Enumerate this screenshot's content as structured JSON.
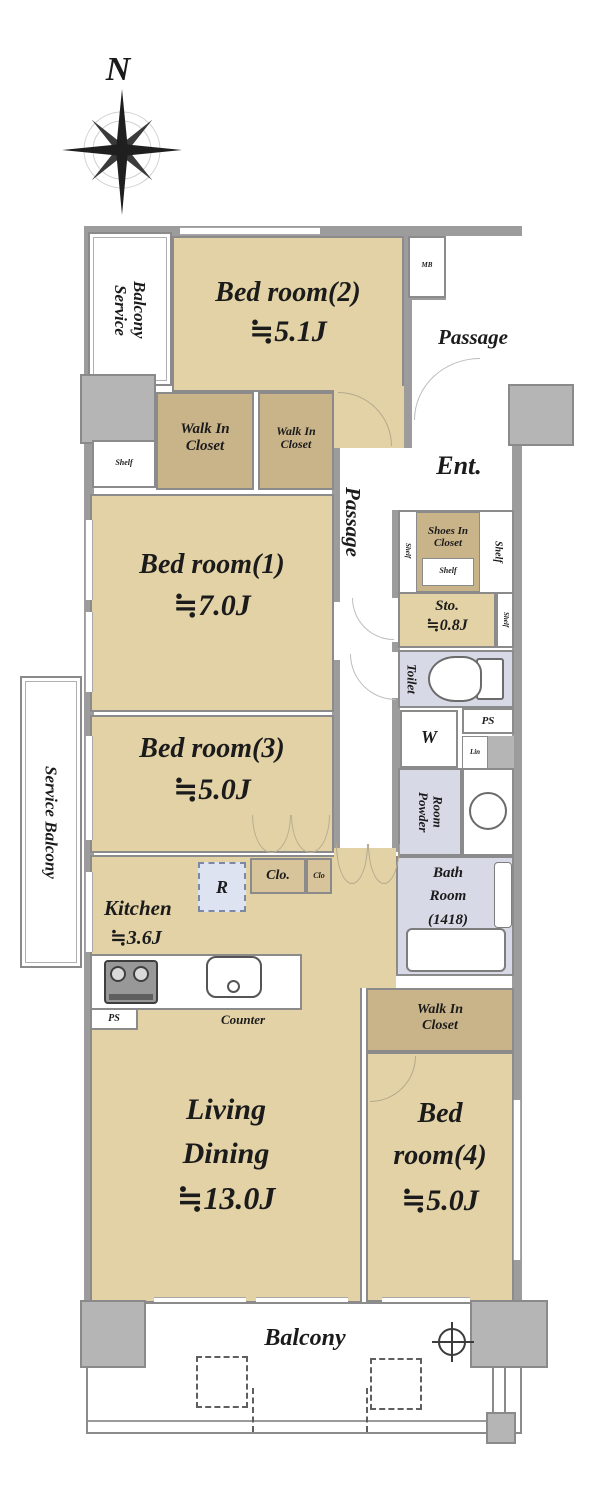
{
  "compass": {
    "north_label": "N"
  },
  "colors": {
    "room_tan": "#e2d2a6",
    "closet_tan": "#c9b389",
    "wet_area_blue": "#d7dae6",
    "wall_gray": "#9c9c9c",
    "pillar_gray": "#b5b5b5"
  },
  "rooms": {
    "service_balcony_top": {
      "line1": "Service",
      "line2": "Balcony"
    },
    "bedroom2": {
      "name": "Bed room(2)",
      "size": "≒5.1J"
    },
    "meter_box": {
      "label": "MB"
    },
    "passage_upper": {
      "label": "Passage"
    },
    "wic1": {
      "line1": "Walk In",
      "line2": "Closet"
    },
    "wic2": {
      "line1": "Walk In",
      "line2": "Closet"
    },
    "shelf_top_left": {
      "label": "Shelf"
    },
    "bedroom1": {
      "name": "Bed room(1)",
      "size": "≒7.0J"
    },
    "passage_inner": {
      "label": "Passage"
    },
    "entrance": {
      "label": "Ent."
    },
    "shoes_in_closet": {
      "line1": "Shoes In",
      "line2": "Closet",
      "shelf_bottom": "Shelf",
      "shelf_left": "Shelf",
      "shelf_right": "Shelf"
    },
    "storage": {
      "name": "Sto.",
      "size": "≒0.8J",
      "shelf_right": "Shelf"
    },
    "toilet": {
      "label": "Toilet"
    },
    "bedroom3": {
      "name": "Bed room(3)",
      "size": "≒5.0J"
    },
    "washer": {
      "label": "W"
    },
    "pipe_space_upper": {
      "label": "PS"
    },
    "linen": {
      "label": "Lin"
    },
    "powder_room": {
      "line1": "Powder",
      "line2": "Room"
    },
    "bath_room": {
      "line1": "Bath",
      "line2": "Room",
      "line3": "(1418)"
    },
    "kitchen": {
      "name": "Kitchen",
      "size": "≒3.6J",
      "counter": "Counter",
      "refrigerator": "R",
      "pipe_space": "PS"
    },
    "closet_large": {
      "label": "Clo."
    },
    "closet_small": {
      "label": "Clo"
    },
    "living_dining": {
      "line1": "Living",
      "line2": "Dining",
      "size": "≒13.0J"
    },
    "wic3": {
      "line1": "Walk In",
      "line2": "Closet"
    },
    "bedroom4": {
      "line1": "Bed",
      "line2": "room(4)",
      "size": "≒5.0J"
    },
    "service_balcony_left": {
      "label": "Service Balcony"
    },
    "balcony": {
      "label": "Balcony"
    }
  }
}
